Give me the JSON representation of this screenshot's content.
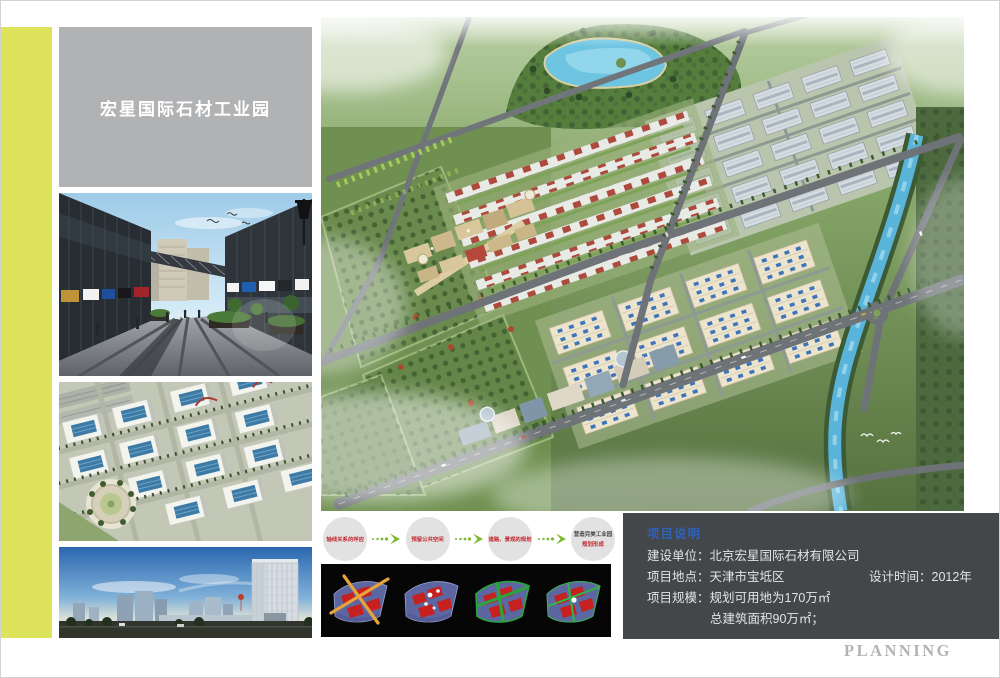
{
  "board": {
    "planning_label": "PLANNING"
  },
  "colors": {
    "accent_bar": "#dde45c",
    "title_box_bg": "#b1b2b4",
    "project_panel_bg": "#43474a",
    "project_header_blue": "#3061b4",
    "flow_text_red": "#c2272f",
    "flow_arrow_green": "#7cb832",
    "diagram_panel_bg": "#060606"
  },
  "title_box": {
    "text": "宏星国际石材工业园"
  },
  "flow": {
    "steps": [
      {
        "label": "轴线关系的呼应"
      },
      {
        "label": "预留公共空间"
      },
      {
        "label": "道路、景观的规划"
      },
      {
        "line1": "营造完美工业园",
        "line2": "规划形成"
      }
    ]
  },
  "project_info": {
    "header": "项目说明",
    "line1_label": "建设单位：",
    "line1_value": "北京宏星国际石材有限公司",
    "line2_label": "项目地点：",
    "line2_value": "天津市宝坻区",
    "line2b_label": "设计时间：",
    "line2b_value": "2012年",
    "line3_label": "项目规模：",
    "line3_value": "规划可用地为170万㎡",
    "line4_value": "总建筑面积90万㎡；"
  }
}
